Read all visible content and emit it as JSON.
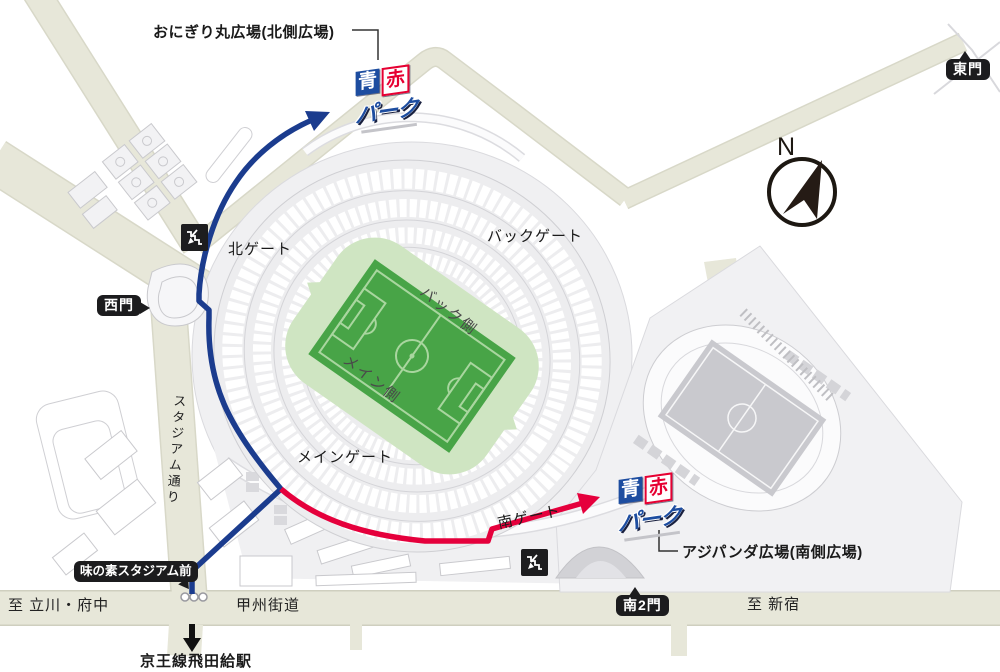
{
  "map": {
    "plazas": {
      "north_label": "おにぎり丸広場(北側広場)",
      "south_label": "アジパンダ広場(南側広場)"
    },
    "gates": {
      "north": "北ゲート",
      "back": "バックゲート",
      "main": "メインゲート",
      "south": "南ゲート",
      "west": "西門",
      "east": "東門",
      "south2": "南2門"
    },
    "stadium_sides": {
      "back_side": "バック側",
      "main_side": "メイン側"
    },
    "roads": {
      "koshu_kaido": "甲州街道",
      "stadium_street": "スタジアム通り",
      "to_tachikawa_fuchu": "至 立川・府中",
      "to_shinjuku": "至 新宿"
    },
    "transit": {
      "bus_stop": "味の素スタジアム前",
      "station": "京王線飛田給駅"
    },
    "compass_n": "N",
    "logo": {
      "ao": "青",
      "aka": "赤",
      "park": "パーク"
    },
    "colors": {
      "route_blue": "#1b3c8e",
      "route_red": "#e5003c",
      "pitch_green": "#48a447",
      "pitch_surround_green": "#cfe5c2",
      "road_beige": "#e7e7d9",
      "plaza_gray": "#f0f0f2",
      "badge_black": "#1c1c1e",
      "logo_blue": "#1d4da0",
      "logo_red": "#e60032"
    }
  }
}
